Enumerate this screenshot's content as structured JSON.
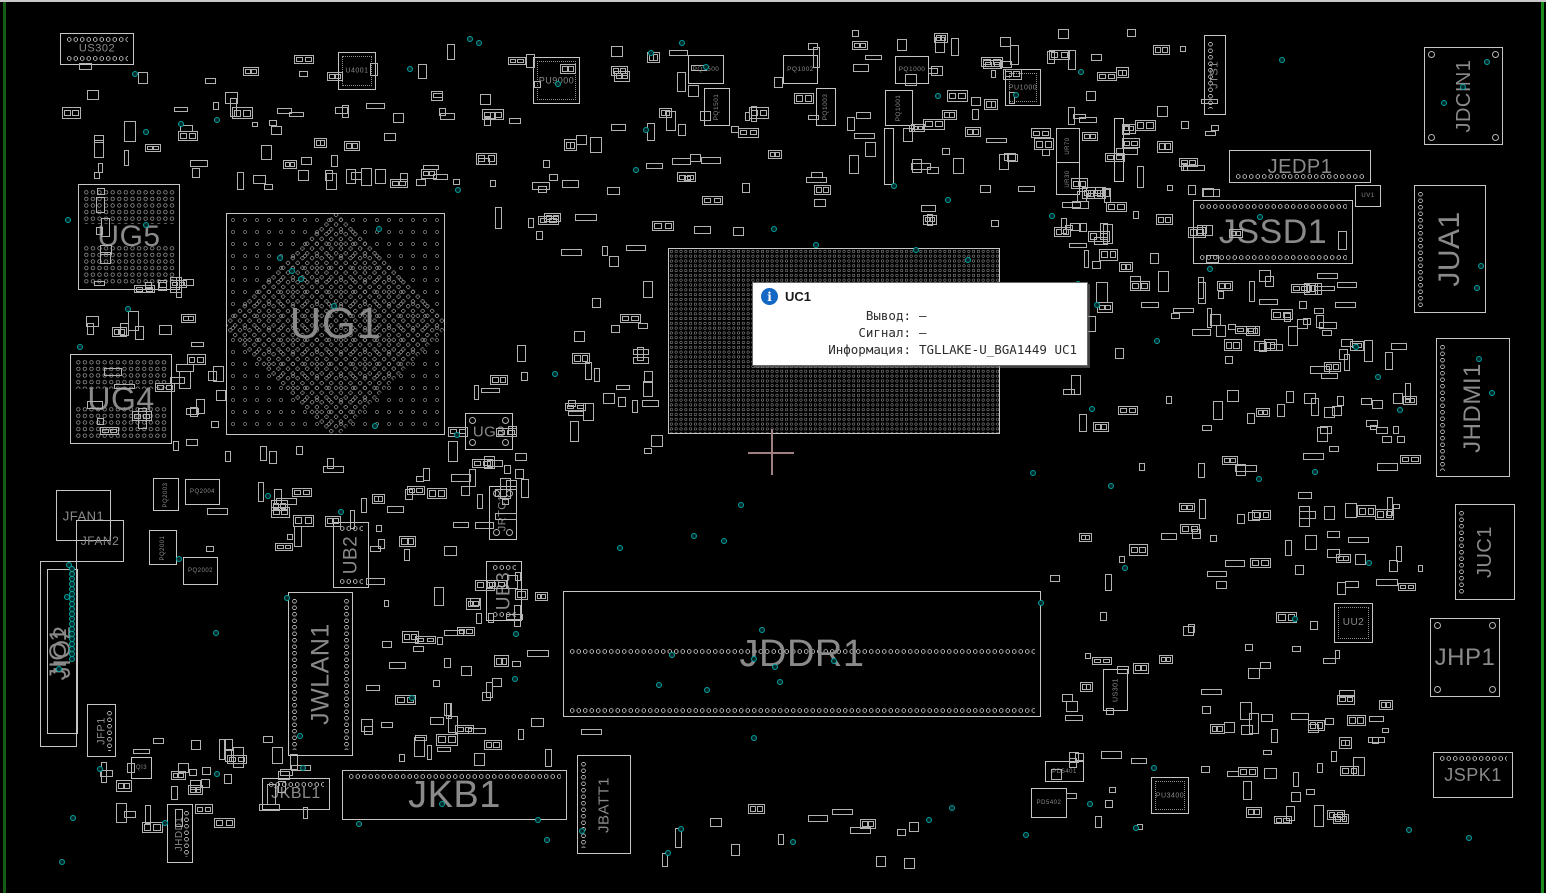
{
  "app": {
    "type": "pcb-boardview-viewer"
  },
  "board": {
    "width": 1546,
    "height": 893,
    "colors": {
      "background": "#000000",
      "outline": "#c6c6c6",
      "pad_dot": "#8a8a8a",
      "label": "#8a8a8a",
      "test_point": "#00a0a0",
      "edge_left": "#145c14",
      "edge_right": "#1d8a1d",
      "window_edge": "#c9c9c9",
      "crosshair": "#a08080",
      "info_icon": "#1268c3"
    }
  },
  "tooltip": {
    "x": 752,
    "y": 282,
    "icon_glyph": "i",
    "title": "UC1",
    "rows": [
      {
        "label": "Вывод:",
        "value": "—"
      },
      {
        "label": "Сигнал:",
        "value": "—"
      },
      {
        "label": "Информация:",
        "value": "TGLLAKE-U_BGA1449 UC1"
      }
    ]
  },
  "crosshair": {
    "x": 771,
    "y": 452
  },
  "components": [
    {
      "n": "US302",
      "x": 60,
      "y": 33,
      "w": 72,
      "h": 30,
      "fs": 11,
      "t": "c",
      "pins": [
        "top",
        "bottom"
      ]
    },
    {
      "n": "U4001",
      "x": 338,
      "y": 52,
      "w": 36,
      "h": 36,
      "fs": 7,
      "t": "q"
    },
    {
      "n": "PU9000",
      "x": 533,
      "y": 57,
      "w": 45,
      "h": 45,
      "fs": 9,
      "t": "q"
    },
    {
      "n": "PQ1500",
      "x": 688,
      "y": 55,
      "w": 34,
      "h": 27,
      "fs": 6.5,
      "t": "r"
    },
    {
      "n": "PQ1501",
      "x": 704,
      "y": 88,
      "w": 24,
      "h": 36,
      "fs": 6.5,
      "v": true,
      "t": "r"
    },
    {
      "n": "PQ1002",
      "x": 783,
      "y": 55,
      "w": 33,
      "h": 27,
      "fs": 6.5,
      "t": "r"
    },
    {
      "n": "PQ1003",
      "x": 816,
      "y": 88,
      "w": 18,
      "h": 36,
      "fs": 6.5,
      "v": true,
      "t": "r"
    },
    {
      "n": "PQ1000",
      "x": 895,
      "y": 56,
      "w": 32,
      "h": 26,
      "fs": 6.5,
      "t": "r"
    },
    {
      "n": "PQ1001",
      "x": 885,
      "y": 90,
      "w": 26,
      "h": 34,
      "fs": 6.5,
      "v": true,
      "t": "r"
    },
    {
      "n": "PU1000",
      "x": 1005,
      "y": 69,
      "w": 34,
      "h": 35,
      "fs": 7,
      "t": "q"
    },
    {
      "n": "UR70",
      "x": 1056,
      "y": 128,
      "w": 22,
      "h": 33,
      "fs": 6,
      "v": true,
      "t": "r"
    },
    {
      "n": "UR30",
      "x": 1056,
      "y": 162,
      "w": 22,
      "h": 31,
      "fs": 6,
      "v": true,
      "t": "r"
    },
    {
      "n": "",
      "x": 884,
      "y": 128,
      "w": 8,
      "h": 55,
      "t": "r"
    },
    {
      "n": "",
      "x": 1114,
      "y": 118,
      "w": 8,
      "h": 62,
      "t": "r"
    },
    {
      "n": "UG5",
      "x": 78,
      "y": 184,
      "w": 100,
      "h": 104,
      "fs": 30,
      "t": "b5"
    },
    {
      "n": "UG1",
      "x": 226,
      "y": 213,
      "w": 217,
      "h": 220,
      "fs": 44,
      "t": "b1"
    },
    {
      "n": "UG4",
      "x": 70,
      "y": 354,
      "w": 100,
      "h": 88,
      "fs": 32,
      "t": "b5"
    },
    {
      "n": "UG3",
      "x": 465,
      "y": 413,
      "w": 46,
      "h": 35,
      "fs": 15,
      "t": "r",
      "pins": [
        "corners"
      ]
    },
    {
      "n": "JRTC1",
      "x": 489,
      "y": 486,
      "w": 26,
      "h": 52,
      "fs": 11,
      "v": true,
      "t": "r",
      "pins": [
        "corners"
      ]
    },
    {
      "n": "UB2",
      "x": 333,
      "y": 522,
      "w": 34,
      "h": 64,
      "fs": 19,
      "v": true,
      "t": "r",
      "pins": [
        "top",
        "bottom"
      ]
    },
    {
      "n": "UB3",
      "x": 486,
      "y": 561,
      "w": 34,
      "h": 58,
      "fs": 19,
      "v": true,
      "t": "r",
      "pins": [
        "top",
        "bottom"
      ]
    },
    {
      "n": "UC1",
      "x": 668,
      "y": 248,
      "w": 330,
      "h": 184,
      "fs": 56,
      "t": "bc",
      "lc": "#6e6e6e"
    },
    {
      "n": "JWLAN1",
      "x": 288,
      "y": 592,
      "w": 63,
      "h": 162,
      "fs": 25,
      "v": true,
      "t": "c",
      "pins": [
        "left",
        "right"
      ]
    },
    {
      "n": "JIO1",
      "x": 40,
      "y": 561,
      "w": 35,
      "h": 184,
      "fs": 24,
      "v": true,
      "t": "r"
    },
    {
      "n": "JIO2",
      "x": 47,
      "y": 569,
      "w": 29,
      "h": 163,
      "fs": 24,
      "v": true,
      "t": "r"
    },
    {
      "n": "JFAN1",
      "x": 56,
      "y": 490,
      "w": 53,
      "h": 49,
      "fs": 13,
      "t": "r"
    },
    {
      "n": "JFAN2",
      "x": 76,
      "y": 520,
      "w": 46,
      "h": 40,
      "fs": 12,
      "t": "r"
    },
    {
      "n": "PQ2003",
      "x": 153,
      "y": 478,
      "w": 24,
      "h": 31,
      "fs": 6,
      "v": true,
      "t": "r"
    },
    {
      "n": "PQ2004",
      "x": 185,
      "y": 479,
      "w": 33,
      "h": 24,
      "fs": 6,
      "t": "r"
    },
    {
      "n": "PQ2001",
      "x": 149,
      "y": 530,
      "w": 26,
      "h": 33,
      "fs": 6,
      "v": true,
      "t": "r"
    },
    {
      "n": "PQ2002",
      "x": 183,
      "y": 557,
      "w": 33,
      "h": 26,
      "fs": 6,
      "t": "r"
    },
    {
      "n": "JFP1",
      "x": 87,
      "y": 704,
      "w": 27,
      "h": 51,
      "fs": 11,
      "v": true,
      "t": "r",
      "pins": [
        "right"
      ]
    },
    {
      "n": "QI3",
      "x": 131,
      "y": 757,
      "w": 19,
      "h": 20,
      "fs": 6,
      "t": "r"
    },
    {
      "n": "JHDD1",
      "x": 167,
      "y": 804,
      "w": 24,
      "h": 57,
      "fs": 10,
      "v": true,
      "t": "r",
      "pins": [
        "right"
      ]
    },
    {
      "n": "JKBL1",
      "x": 262,
      "y": 778,
      "w": 66,
      "h": 30,
      "fs": 16,
      "t": "c",
      "pins": [
        "top"
      ]
    },
    {
      "n": "JKB1",
      "x": 342,
      "y": 770,
      "w": 223,
      "h": 48,
      "fs": 38,
      "t": "c",
      "pins": [
        "top"
      ]
    },
    {
      "n": "JBATT1",
      "x": 577,
      "y": 755,
      "w": 52,
      "h": 97,
      "fs": 15,
      "v": true,
      "t": "c",
      "pins": [
        "left"
      ]
    },
    {
      "n": "JDDR1",
      "x": 563,
      "y": 591,
      "w": 476,
      "h": 124,
      "fs": 38,
      "t": "c",
      "pins": [
        "mid",
        "bottom"
      ]
    },
    {
      "n": "US301",
      "x": 1103,
      "y": 669,
      "w": 23,
      "h": 40,
      "fs": 7,
      "v": true,
      "t": "r"
    },
    {
      "n": "PD5401",
      "x": 1045,
      "y": 761,
      "w": 37,
      "h": 19,
      "fs": 6,
      "t": "r"
    },
    {
      "n": "PD5402",
      "x": 1031,
      "y": 788,
      "w": 34,
      "h": 28,
      "fs": 6,
      "t": "r"
    },
    {
      "n": "PU3400",
      "x": 1151,
      "y": 777,
      "w": 36,
      "h": 35,
      "fs": 7,
      "t": "q"
    },
    {
      "n": "UU2",
      "x": 1334,
      "y": 603,
      "w": 37,
      "h": 38,
      "fs": 10,
      "t": "q"
    },
    {
      "n": "JTS1",
      "x": 1204,
      "y": 35,
      "w": 20,
      "h": 78,
      "fs": 11,
      "v": true,
      "t": "r",
      "pins": [
        "left"
      ]
    },
    {
      "n": "JDCIN1",
      "x": 1424,
      "y": 47,
      "w": 77,
      "h": 96,
      "fs": 20,
      "v": true,
      "t": "c",
      "pins": [
        "corners"
      ]
    },
    {
      "n": "JEDP1",
      "x": 1229,
      "y": 150,
      "w": 140,
      "h": 31,
      "fs": 20,
      "t": "c",
      "pins": [
        "bottom"
      ]
    },
    {
      "n": "UV1",
      "x": 1355,
      "y": 185,
      "w": 24,
      "h": 20,
      "fs": 6,
      "t": "r"
    },
    {
      "n": "JSSD1",
      "x": 1193,
      "y": 200,
      "w": 158,
      "h": 62,
      "fs": 34,
      "t": "c",
      "pins": [
        "top",
        "bottom"
      ]
    },
    {
      "n": "JUA1",
      "x": 1414,
      "y": 185,
      "w": 70,
      "h": 126,
      "fs": 30,
      "v": true,
      "t": "c",
      "pins": [
        "left"
      ]
    },
    {
      "n": "JHDMI1",
      "x": 1436,
      "y": 338,
      "w": 72,
      "h": 137,
      "fs": 24,
      "v": true,
      "t": "c",
      "pins": [
        "left"
      ]
    },
    {
      "n": "JUC1",
      "x": 1455,
      "y": 504,
      "w": 58,
      "h": 94,
      "fs": 20,
      "v": true,
      "t": "c",
      "pins": [
        "left"
      ]
    },
    {
      "n": "JHP1",
      "x": 1430,
      "y": 618,
      "w": 68,
      "h": 77,
      "fs": 24,
      "t": "c",
      "pins": [
        "corners"
      ]
    },
    {
      "n": "JSPK1",
      "x": 1433,
      "y": 752,
      "w": 78,
      "h": 44,
      "fs": 18,
      "t": "c",
      "pins": [
        "top"
      ]
    }
  ],
  "decoration": {
    "seed": 11,
    "clusters": [
      {
        "x": 60,
        "y": 55,
        "w": 390,
        "h": 130,
        "n": 48
      },
      {
        "x": 440,
        "y": 35,
        "w": 390,
        "h": 205,
        "n": 70
      },
      {
        "x": 840,
        "y": 28,
        "w": 350,
        "h": 210,
        "n": 80
      },
      {
        "x": 1055,
        "y": 95,
        "w": 170,
        "h": 160,
        "n": 30
      },
      {
        "x": 85,
        "y": 300,
        "w": 120,
        "h": 150,
        "n": 22
      },
      {
        "x": 555,
        "y": 245,
        "w": 112,
        "h": 215,
        "n": 30
      },
      {
        "x": 200,
        "y": 445,
        "w": 330,
        "h": 108,
        "n": 40
      },
      {
        "x": 180,
        "y": 335,
        "w": 44,
        "h": 120,
        "n": 8
      },
      {
        "x": 445,
        "y": 340,
        "w": 85,
        "h": 168,
        "n": 18
      },
      {
        "x": 355,
        "y": 535,
        "w": 200,
        "h": 230,
        "n": 48
      },
      {
        "x": 1055,
        "y": 225,
        "w": 300,
        "h": 345,
        "n": 85
      },
      {
        "x": 1295,
        "y": 335,
        "w": 138,
        "h": 260,
        "n": 40
      },
      {
        "x": 1045,
        "y": 555,
        "w": 310,
        "h": 275,
        "n": 50
      },
      {
        "x": 100,
        "y": 735,
        "w": 210,
        "h": 105,
        "n": 38
      },
      {
        "x": 380,
        "y": 725,
        "w": 240,
        "h": 50,
        "n": 10
      },
      {
        "x": 1185,
        "y": 265,
        "w": 180,
        "h": 85,
        "n": 22
      },
      {
        "x": 640,
        "y": 800,
        "w": 280,
        "h": 70,
        "n": 14
      },
      {
        "x": 1200,
        "y": 700,
        "w": 200,
        "h": 130,
        "n": 28
      },
      {
        "x": 108,
        "y": 276,
        "w": 90,
        "h": 16,
        "n": 8
      },
      {
        "x": 230,
        "y": 168,
        "w": 220,
        "h": 20,
        "n": 14
      },
      {
        "x": 92,
        "y": 188,
        "w": 20,
        "h": 115,
        "n": 7
      }
    ],
    "test_points": {
      "n": 115,
      "x": 55,
      "y": 35,
      "w": 1435,
      "h": 825
    },
    "jio_strip": {
      "x": 69,
      "y1": 566,
      "y2": 660,
      "step": 5
    }
  }
}
